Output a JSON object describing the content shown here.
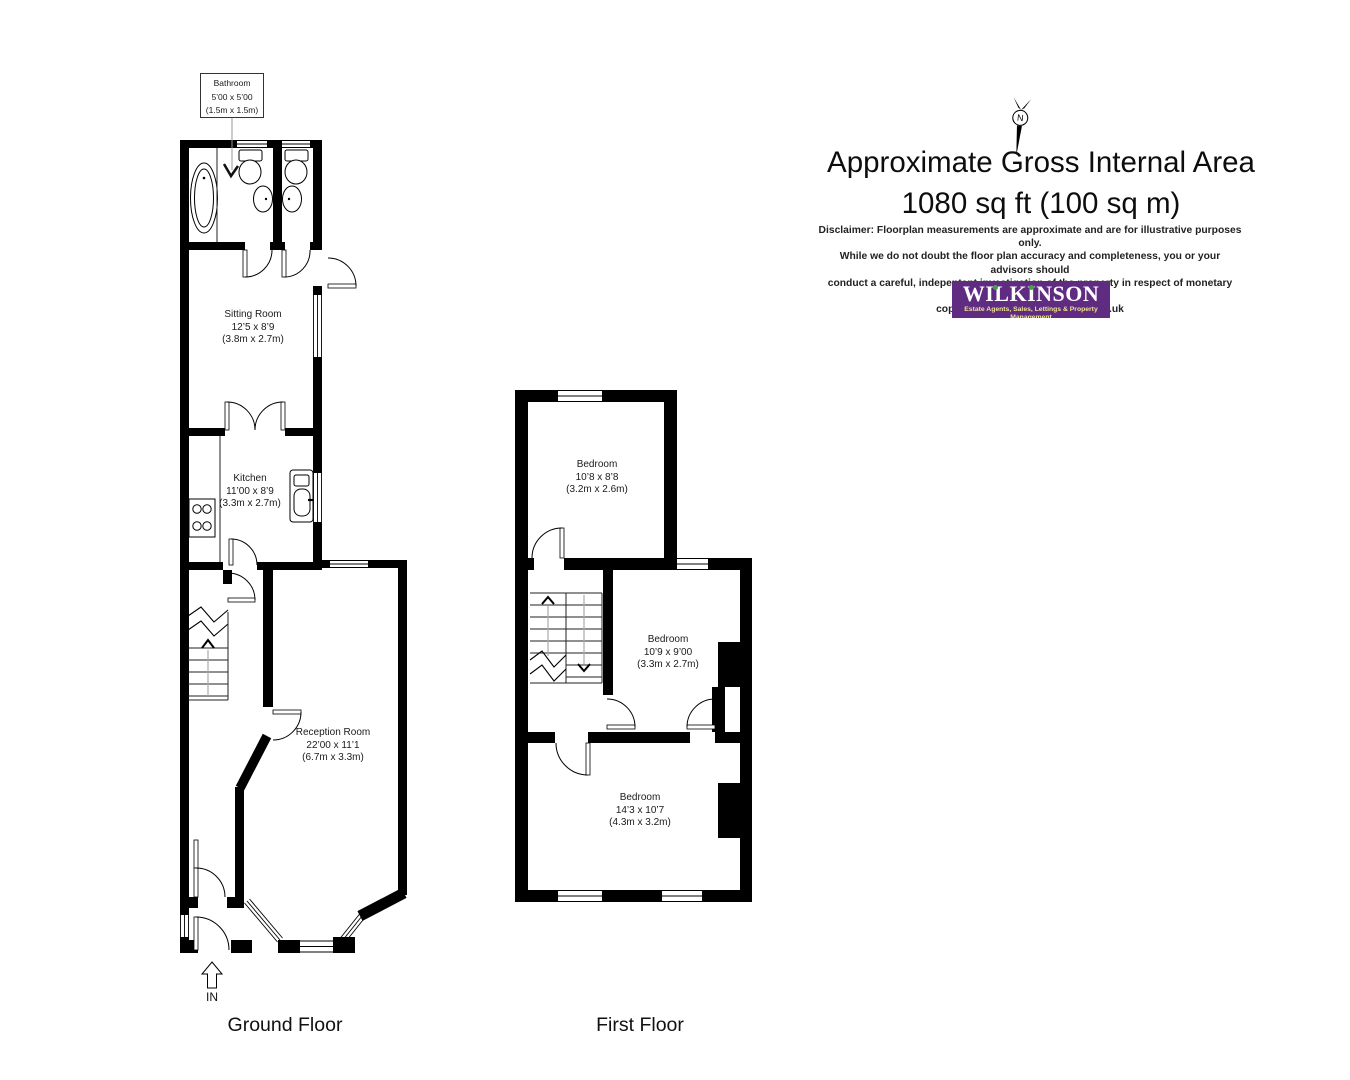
{
  "header": {
    "title_line1": "Approximate Gross Internal Area",
    "title_line2": "1080 sq ft (100 sq m)",
    "compass_label": "N",
    "disclaimer_lines": [
      "Disclaimer: Floorplan measurements are approximate and are for illustrative purposes only.",
      "While we do not doubt the floor plan accuracy and completeness, you or your advisors should",
      "conduct a careful, indepentent investigation of the property in respect of monetary valuation.",
      "copyright www.photohausgroup.co.uk"
    ]
  },
  "logo": {
    "name": "WILKINSON",
    "tagline": "Estate Agents, Sales, Lettings & Property Management",
    "background_color": "#5F2C82",
    "text_color": "#FFFFFF",
    "dot_color": "#3FA63F",
    "tagline_color": "#EFE48E"
  },
  "floors": {
    "ground": {
      "label": "Ground Floor"
    },
    "first": {
      "label": "First Floor"
    }
  },
  "rooms": {
    "bathroom": {
      "name": "Bathroom",
      "size_ft": "5’00 x 5’00",
      "size_m": "(1.5m x 1.5m)"
    },
    "sitting_room": {
      "name": "Sitting Room",
      "size_ft": "12’5 x 8’9",
      "size_m": "(3.8m x 2.7m)"
    },
    "kitchen": {
      "name": "Kitchen",
      "size_ft": "11’00 x 8’9",
      "size_m": "(3.3m x 2.7m)"
    },
    "reception_room": {
      "name": "Reception Room",
      "size_ft": "22’00 x 11’1",
      "size_m": "(6.7m x 3.3m)"
    },
    "bedroom_1": {
      "name": "Bedroom",
      "size_ft": "10’8 x 8’8",
      "size_m": "(3.2m x 2.6m)"
    },
    "bedroom_2": {
      "name": "Bedroom",
      "size_ft": "10’9 x 9’00",
      "size_m": "(3.3m x 2.7m)"
    },
    "bedroom_3": {
      "name": "Bedroom",
      "size_ft": "14’3 x 10’7",
      "size_m": "(4.3m x 3.2m)"
    }
  },
  "entrance": {
    "label": "IN"
  }
}
